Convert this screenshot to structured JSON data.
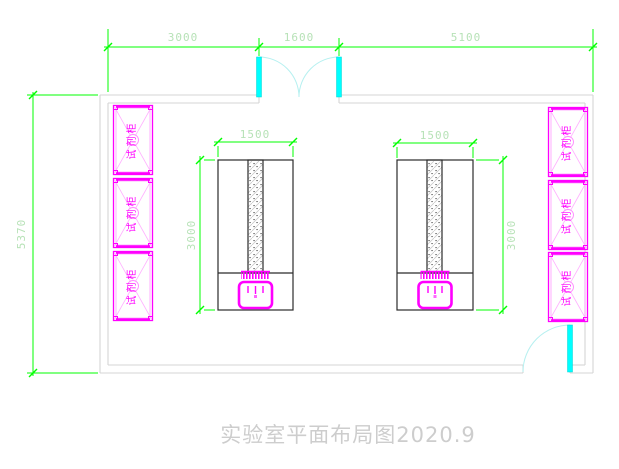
{
  "drawing": {
    "title": "实验室平面布局图2020.9",
    "dims": {
      "top_left": "3000",
      "top_mid": "1600",
      "top_right": "5100",
      "left_height": "5370",
      "bench1_width": "1500",
      "bench1_depth": "3000",
      "bench2_width": "1500",
      "bench2_depth": "3000"
    },
    "cabinet_label": "试剂柜",
    "colors": {
      "dimension_line": "#00ff00",
      "dimension_text": "#b7e2b7",
      "cabinet": "#ff00ff",
      "door_leaf": "#00ffff",
      "door_swing": "#b5f0f0",
      "wall": "#d5d5d5",
      "bench_outline": "#2b2b2b",
      "title_text": "#cdcdcd",
      "background": "#ffffff"
    }
  }
}
